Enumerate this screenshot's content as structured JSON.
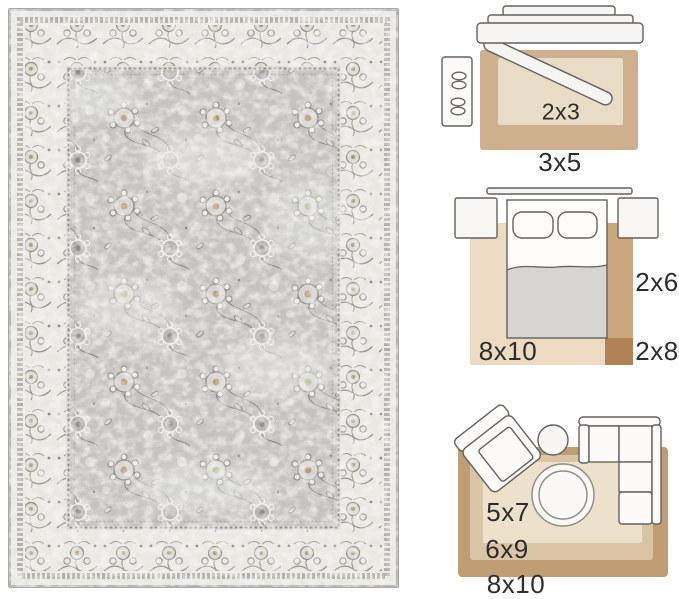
{
  "rug_photo": {
    "palette": {
      "binding": "#b6b5b1",
      "outer_band_ivory": "#ebe9e3",
      "border_ivory": "#eae8e2",
      "motif_gray": "#8c8c86",
      "field_gray": "#c5c4c1",
      "accent_gold": "#ab945c"
    }
  },
  "size_guide": {
    "label_color": "#2d2d2d",
    "entryway": {
      "inner_rug_label": "2x3",
      "outer_rug_label": "3x5",
      "colors": {
        "outer_rug": "#cfb08e",
        "inner_rug": "#e9dcc6"
      }
    },
    "bedroom": {
      "area_rug_label": "8x10",
      "runner_label": "2x6",
      "long_runner_label": "2x8",
      "colors": {
        "area_rug": "#ecdbc2",
        "runner": "#cba77d",
        "long_runner": "#b08255"
      }
    },
    "living_room": {
      "small_rug_label": "5x7",
      "medium_rug_label": "6x9",
      "large_rug_label": "8x10",
      "colors": {
        "large_rug": "#c19d74",
        "medium_rug": "#d9c5a6",
        "small_rug": "#ede1cc"
      }
    }
  }
}
